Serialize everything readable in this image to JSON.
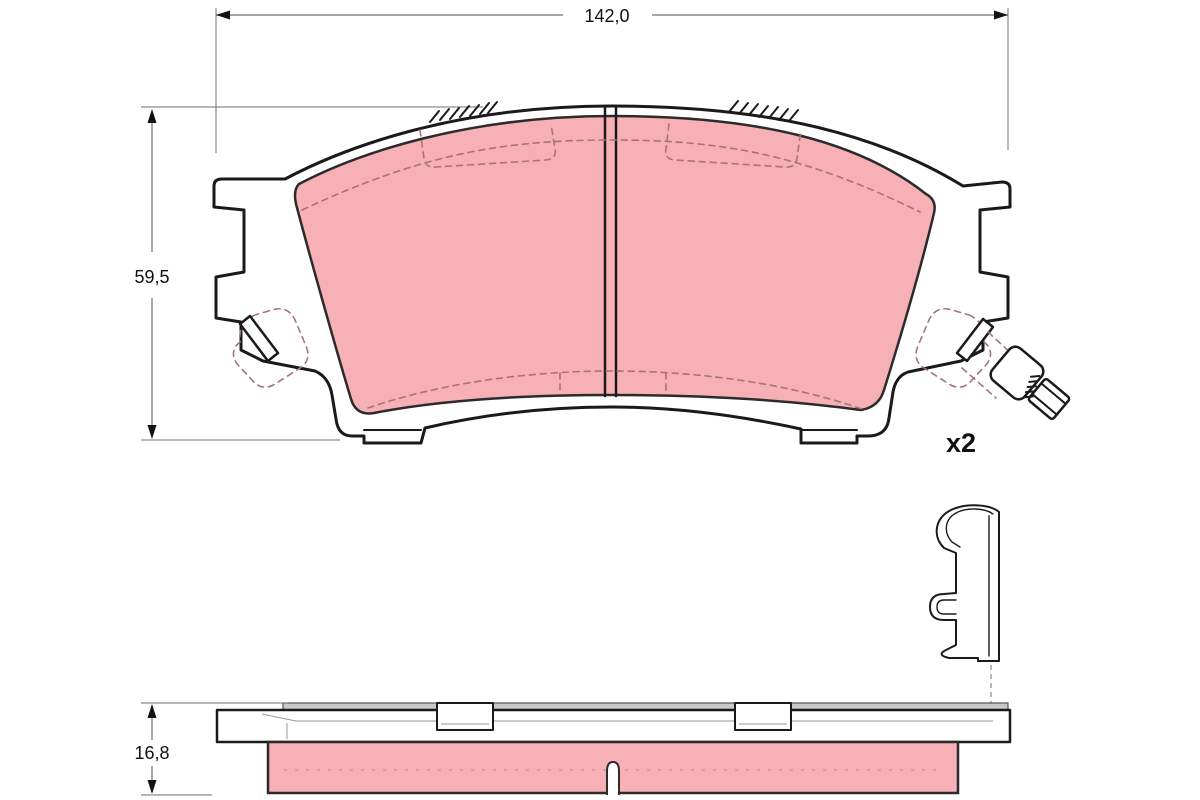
{
  "dimensions": {
    "width_label": "142,0",
    "height_label": "59,5",
    "thickness_label": "16,8"
  },
  "quantity_label": "x2",
  "colors": {
    "friction": "#f6b0b6",
    "friction_outline": "#2b2b2b",
    "outline": "#1a1a1a",
    "hidden_line": "#a57575",
    "dimension_line": "#6f6f6f",
    "shim": "#c8c8c8",
    "text": "#111111"
  }
}
